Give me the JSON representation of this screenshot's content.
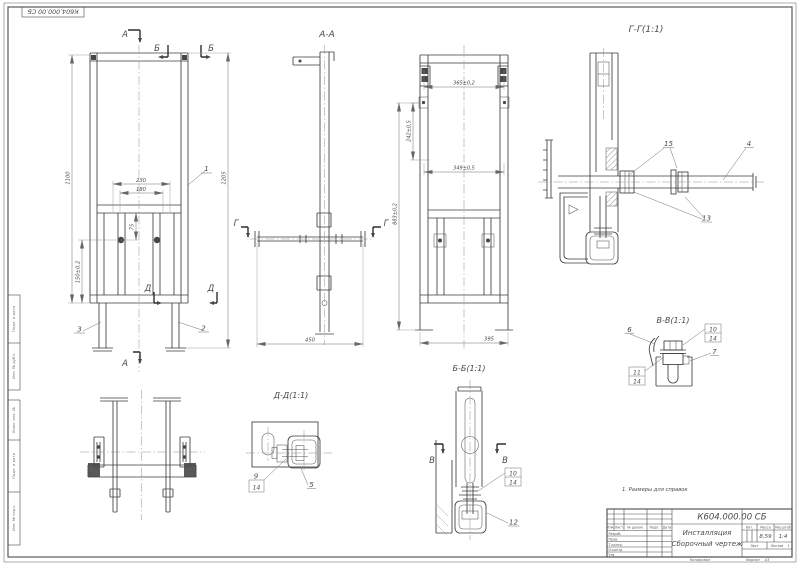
{
  "sheet": {
    "corner_stamp": "К604.000.00 СБ",
    "note": "1. Размеры для справок",
    "side_labels": [
      "Подп. и дата",
      "Инв. № дубл.",
      "Взам. инв. №",
      "Подп. и дата",
      "Инв. № подл."
    ]
  },
  "labels": {
    "aa": "А-А",
    "bb": "Б-Б(1:1)",
    "vv": "В-В(1:1)",
    "gg": "Г-Г(1:1)",
    "dd": "Д-Д(1:1)"
  },
  "marks": {
    "a": "А",
    "b": "Б",
    "v": "В",
    "g": "Г",
    "d": "Д"
  },
  "dims": {
    "front": {
      "d230": "230",
      "d180": "180",
      "d1100": "1100",
      "d1205": "1205",
      "d150": "150±0,2",
      "d75": "75"
    },
    "aa": {
      "d450": "450"
    },
    "side": {
      "d365": "365±0,2",
      "d242": "242±0,5",
      "d349": "349±0,5",
      "d883": "883±0,2",
      "d395": "395"
    }
  },
  "callouts": {
    "c1": "1",
    "c2": "2",
    "c3": "3",
    "c4": "4",
    "c5": "5",
    "c6": "6",
    "c7": "7",
    "c9": "9",
    "c10": "10",
    "c11": "11",
    "c12": "12",
    "c13": "13",
    "c14": "14",
    "c15": "15"
  },
  "tb": {
    "doc_number": "К604.000.00 СБ",
    "title": "Инсталляция",
    "subtitle": "Сборочный чертеж",
    "col_izm": "Изм.",
    "col_list": "Лист",
    "col_doc": "№ докум.",
    "col_podp": "Подп.",
    "col_data": "Дата",
    "row_razrab": "Разраб.",
    "row_prov": "Пров.",
    "row_tkontr": "Т.контр.",
    "row_nkontr": "Н.контр.",
    "row_utv": "Утв.",
    "lit_label": "Лит.",
    "mass_label": "Масса",
    "scale_label": "Масштаб",
    "mass_value": "8,59",
    "scale_value": "1:4",
    "sheet_label": "Лист",
    "sheets_label": "Листов",
    "sheets_value": "1",
    "kopiroval": "Копировал",
    "format_label": "Формат",
    "format_value": "А3"
  }
}
